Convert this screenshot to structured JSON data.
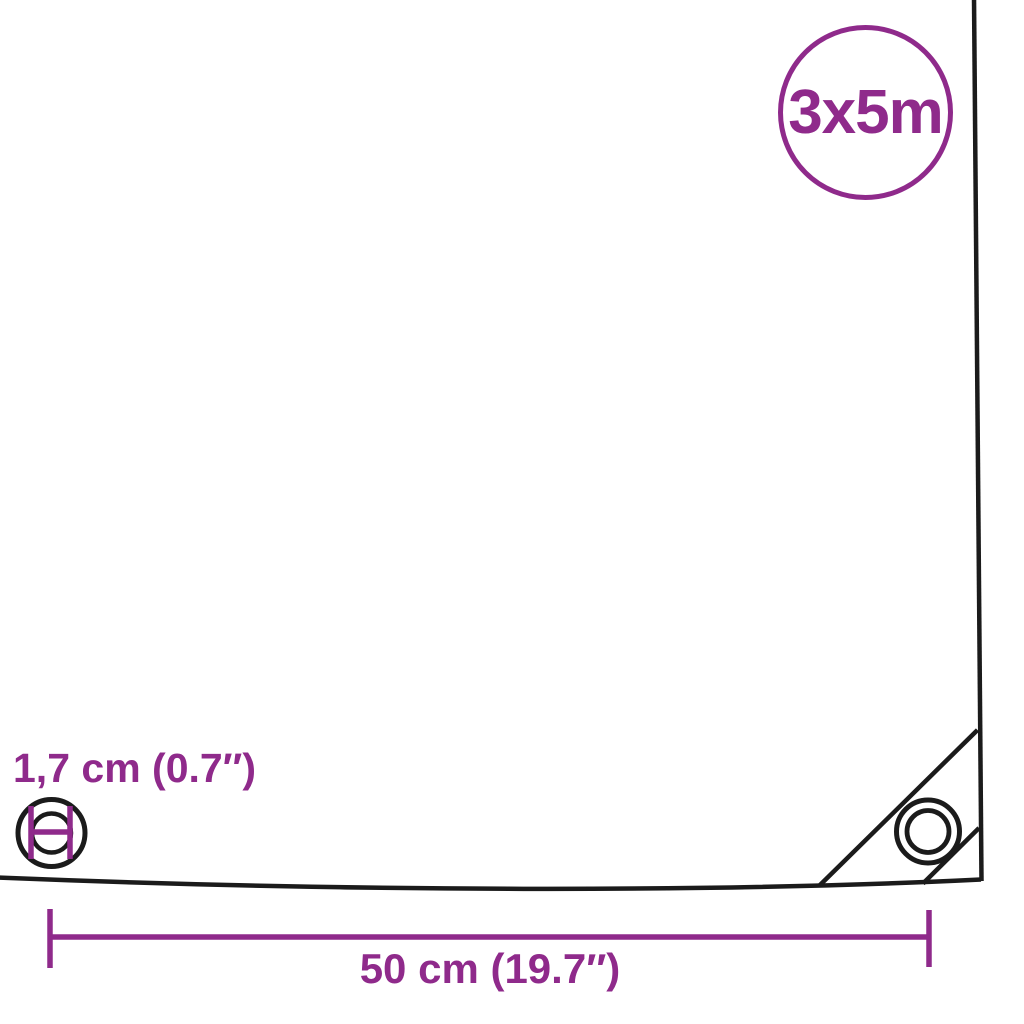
{
  "colors": {
    "accent": "#8f2a8b",
    "line": "#1b1b1b",
    "background": "#ffffff"
  },
  "diagram": {
    "size_badge_label": "3x5m",
    "eyelet_diameter_label": "1,7 cm (0.7″)",
    "eyelet_edge_distance_label": "50 cm (19.7″)"
  },
  "icons": {
    "size_badge": "circle-outline",
    "eyelet_diameter_icon": "double-circle-with-diameter-bars",
    "corner_eyelet_icon": "double-circle-grommet",
    "corner_reinforcement": "diagonal-seam-lines",
    "dimension_line": "horizontal-line-with-end-ticks"
  }
}
